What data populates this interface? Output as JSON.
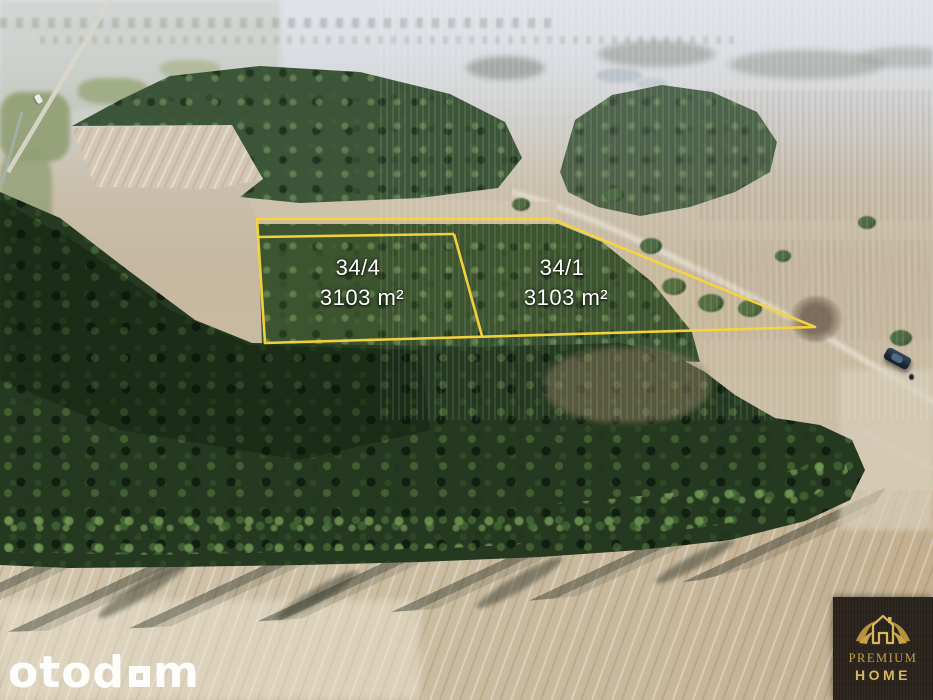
{
  "photo": {
    "description": "Aerial drone photo of rural land for sale: two adjacent building plots outlined in yellow between pine forests, meadows and plowed fields",
    "outline_color": "#f7d53c",
    "label_color": "#ffffff"
  },
  "plots": [
    {
      "id": "34/4",
      "area": "3103 m²"
    },
    {
      "id": "34/1",
      "area": "3103 m²"
    }
  ],
  "watermark": {
    "prefix": "otod",
    "suffix": "m",
    "square_glyph": "▫",
    "color": "#ffffff"
  },
  "logo": {
    "line1": "PREMIUM",
    "line2": "HOME",
    "icon": "house-with-laurel",
    "gold": "#c3a049",
    "background": "#2e2620"
  }
}
